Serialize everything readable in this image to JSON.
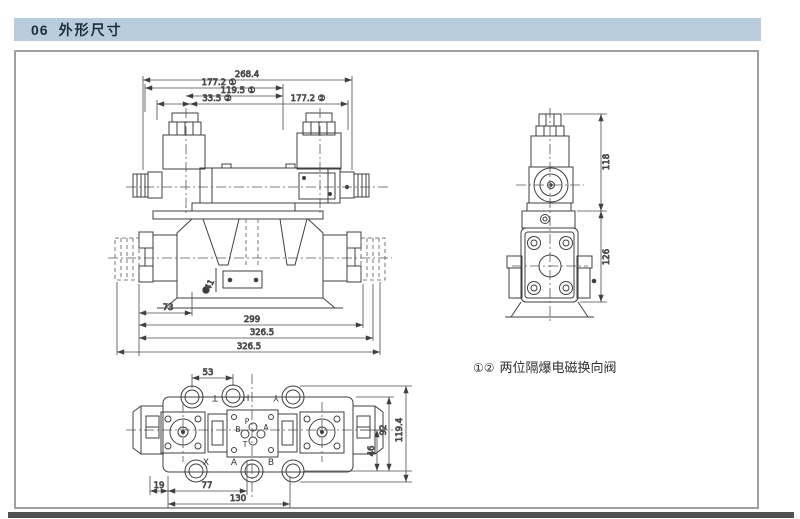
{
  "page": {
    "header_number": "06",
    "header_title": "外形尺寸",
    "note_markers": "①②",
    "note_text": "两位隔爆电磁换向阀"
  },
  "colors": {
    "header_bg": "#b7cddc",
    "header_text": "#1d2d3d",
    "drawing_line": "#3f3f3f",
    "frame_border": "#9f9f9f",
    "bottom_bar": "#525252"
  },
  "front_view": {
    "dims_top": [
      "268.4",
      "177.2 ①",
      "119.5 ①",
      "33.5 ②",
      "177.2 ②"
    ],
    "dims_bottom": [
      "73",
      "299",
      "326.5",
      "326.5"
    ],
    "callout": "41"
  },
  "side_view": {
    "dims": [
      "118",
      "126"
    ]
  },
  "bottom_view": {
    "dim_top": "53",
    "dims_right": [
      "46",
      "92",
      "119.4"
    ],
    "dims_bottom": [
      "19",
      "77",
      "130"
    ],
    "labels_top": [
      "T",
      "H",
      "Y"
    ],
    "labels_bottom": [
      "X",
      "A",
      "B"
    ],
    "port_labels": [
      "P",
      "A",
      "B",
      "T"
    ]
  }
}
